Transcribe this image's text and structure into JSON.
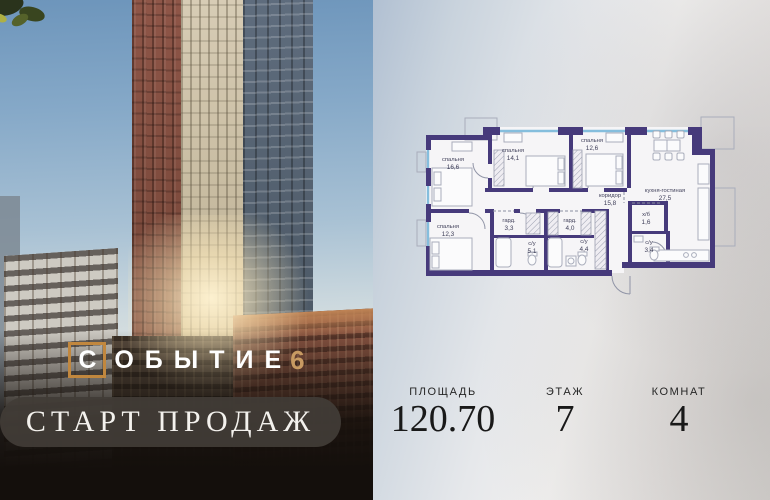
{
  "brand": {
    "logo_text": "ОБЫТИЕ",
    "logo_first_letter": "С",
    "logo_number": "6",
    "banner": "СТАРТ ПРОДАЖ"
  },
  "plan": {
    "rooms": [
      {
        "name": "спальня",
        "area": "16,6"
      },
      {
        "name": "спальня",
        "area": "14,1"
      },
      {
        "name": "спальня",
        "area": "12,6"
      },
      {
        "name": "кухня-гостиная",
        "area": "27,5"
      },
      {
        "name": "коридор",
        "area": "15,8"
      },
      {
        "name": "спальня",
        "area": "12,3"
      },
      {
        "name": "гард.",
        "area": "3,3"
      },
      {
        "name": "с/у",
        "area": "5,1"
      },
      {
        "name": "гард.",
        "area": "4,0"
      },
      {
        "name": "с/у",
        "area": "4,4"
      },
      {
        "name": "х/б",
        "area": "1,6"
      },
      {
        "name": "с/у",
        "area": "3,4"
      }
    ],
    "colors": {
      "wall": "#463a7b",
      "window": "#85bedd",
      "furniture": "#a9adbb",
      "label": "#3e3e58"
    }
  },
  "info": {
    "items": [
      {
        "label": "ПЛОЩАДЬ",
        "value": "120.70"
      },
      {
        "label": "ЭТАЖ",
        "value": "7"
      },
      {
        "label": "КОМНАТ",
        "value": "4"
      }
    ]
  },
  "colors": {
    "accent_orange": "#c1873e",
    "accent_gold": "#c79a62",
    "banner_bg": "#423c37",
    "sky": "#6d95bb"
  }
}
